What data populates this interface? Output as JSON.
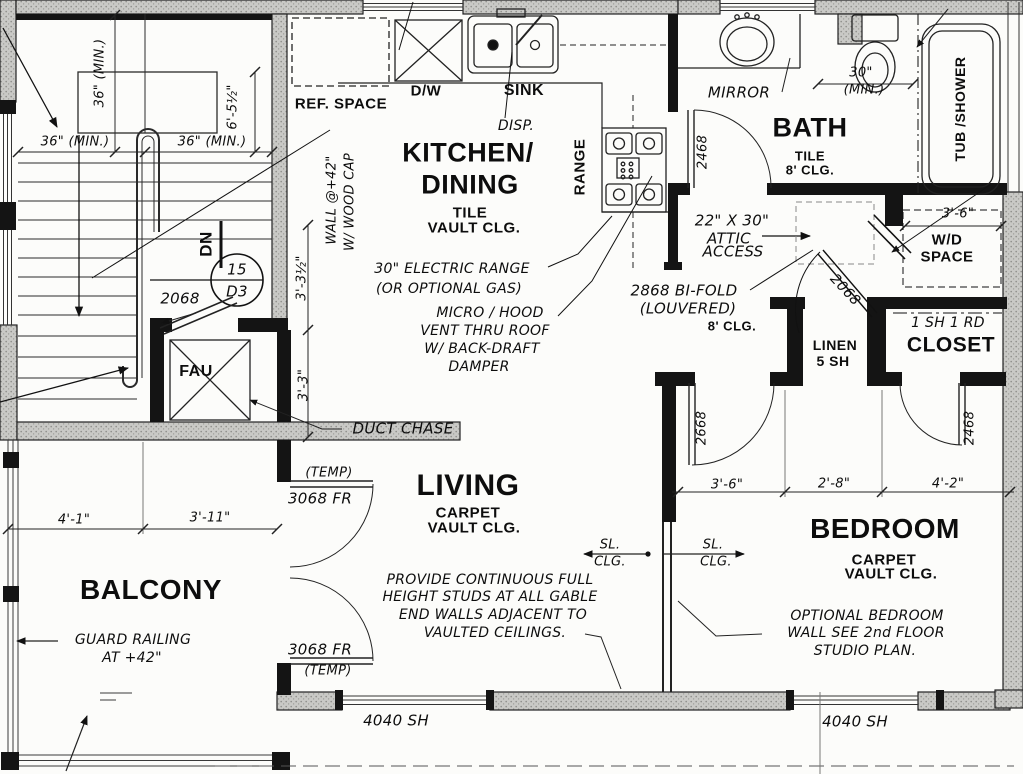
{
  "stairs": {
    "dim_w_left": "36\" (MIN.)",
    "dim_w_right": "36\" (MIN.)",
    "dim_h": "36\" (MIN.)",
    "dim_h2": "6'-5½\"",
    "down": "DN",
    "detail_top": "15",
    "detail_bottom": "D3",
    "door": "2068"
  },
  "fau": {
    "label": "FAU",
    "duct": "DUCT CHASE",
    "dim_a": "3'-3½\"",
    "dim_b": "3'-3\"",
    "wall_note_1": "WALL @+42\"",
    "wall_note_2": "W/ WOOD CAP"
  },
  "kitchen": {
    "title_1": "KITCHEN/",
    "title_2": "DINING",
    "floor": "TILE",
    "ceiling": "VAULT CLG.",
    "ref": "REF. SPACE",
    "dw": "D/W",
    "sink": "SINK",
    "disp": "DISP.",
    "range": "RANGE",
    "note_range_1": "30\" ELECTRIC RANGE",
    "note_range_2": "(OR OPTIONAL GAS)",
    "note_micro_1": "MICRO / HOOD",
    "note_micro_2": "VENT THRU ROOF",
    "note_micro_3": "W/ BACK-DRAFT",
    "note_micro_4": "DAMPER"
  },
  "bath": {
    "title": "BATH",
    "floor": "TILE",
    "ceiling": "8' CLG.",
    "mirror": "MIRROR",
    "tub": "TUB /SHOWER",
    "toilet_dim_1": "30\"",
    "toilet_dim_2": "(MIN.)",
    "door": "2468"
  },
  "hall": {
    "attic_1": "22\" X 30\"",
    "attic_2": "ATTIC",
    "attic_3": "ACCESS",
    "bifold_1": "2868 BI-FOLD",
    "bifold_2": "(LOUVERED)",
    "ceiling": "8' CLG.",
    "door": "2068"
  },
  "wd": {
    "line1": "W/D",
    "line2": "SPACE",
    "dim": "3'-6\""
  },
  "closet": {
    "title": "CLOSET",
    "shelf": "1 SH  1 RD",
    "door": "2468"
  },
  "linen": {
    "title": "LINEN",
    "shelves": "5 SH"
  },
  "alcove": {
    "door_left": "2668",
    "dim_1": "3'-6\"",
    "dim_2": "2'-8\"",
    "dim_3": "4'-2\""
  },
  "living": {
    "title": "LIVING",
    "floor": "CARPET",
    "ceiling": "VAULT CLG.",
    "door_top_temp": "(TEMP)",
    "door_top": "3068 FR",
    "door_bottom": "3068 FR",
    "door_bottom_temp": "(TEMP)",
    "sl": "SL.",
    "clg": "CLG.",
    "note_1": "PROVIDE CONTINUOUS FULL",
    "note_2": "HEIGHT STUDS AT ALL GABLE",
    "note_3": "END WALLS ADJACENT TO",
    "note_4": "VAULTED CEILINGS."
  },
  "bedroom": {
    "title": "BEDROOM",
    "floor": "CARPET",
    "ceiling": "VAULT CLG.",
    "sl": "SL.",
    "clg": "CLG.",
    "note_1": "OPTIONAL BEDROOM",
    "note_2": "WALL SEE 2nd FLOOR",
    "note_3": "STUDIO PLAN."
  },
  "balcony": {
    "title": "BALCONY",
    "note_1": "GUARD RAILING",
    "note_2": "AT +42\"",
    "dim_1": "4'-1\"",
    "dim_2": "3'-11\""
  },
  "windows": {
    "left": "4040 SH",
    "right": "4040 SH"
  }
}
